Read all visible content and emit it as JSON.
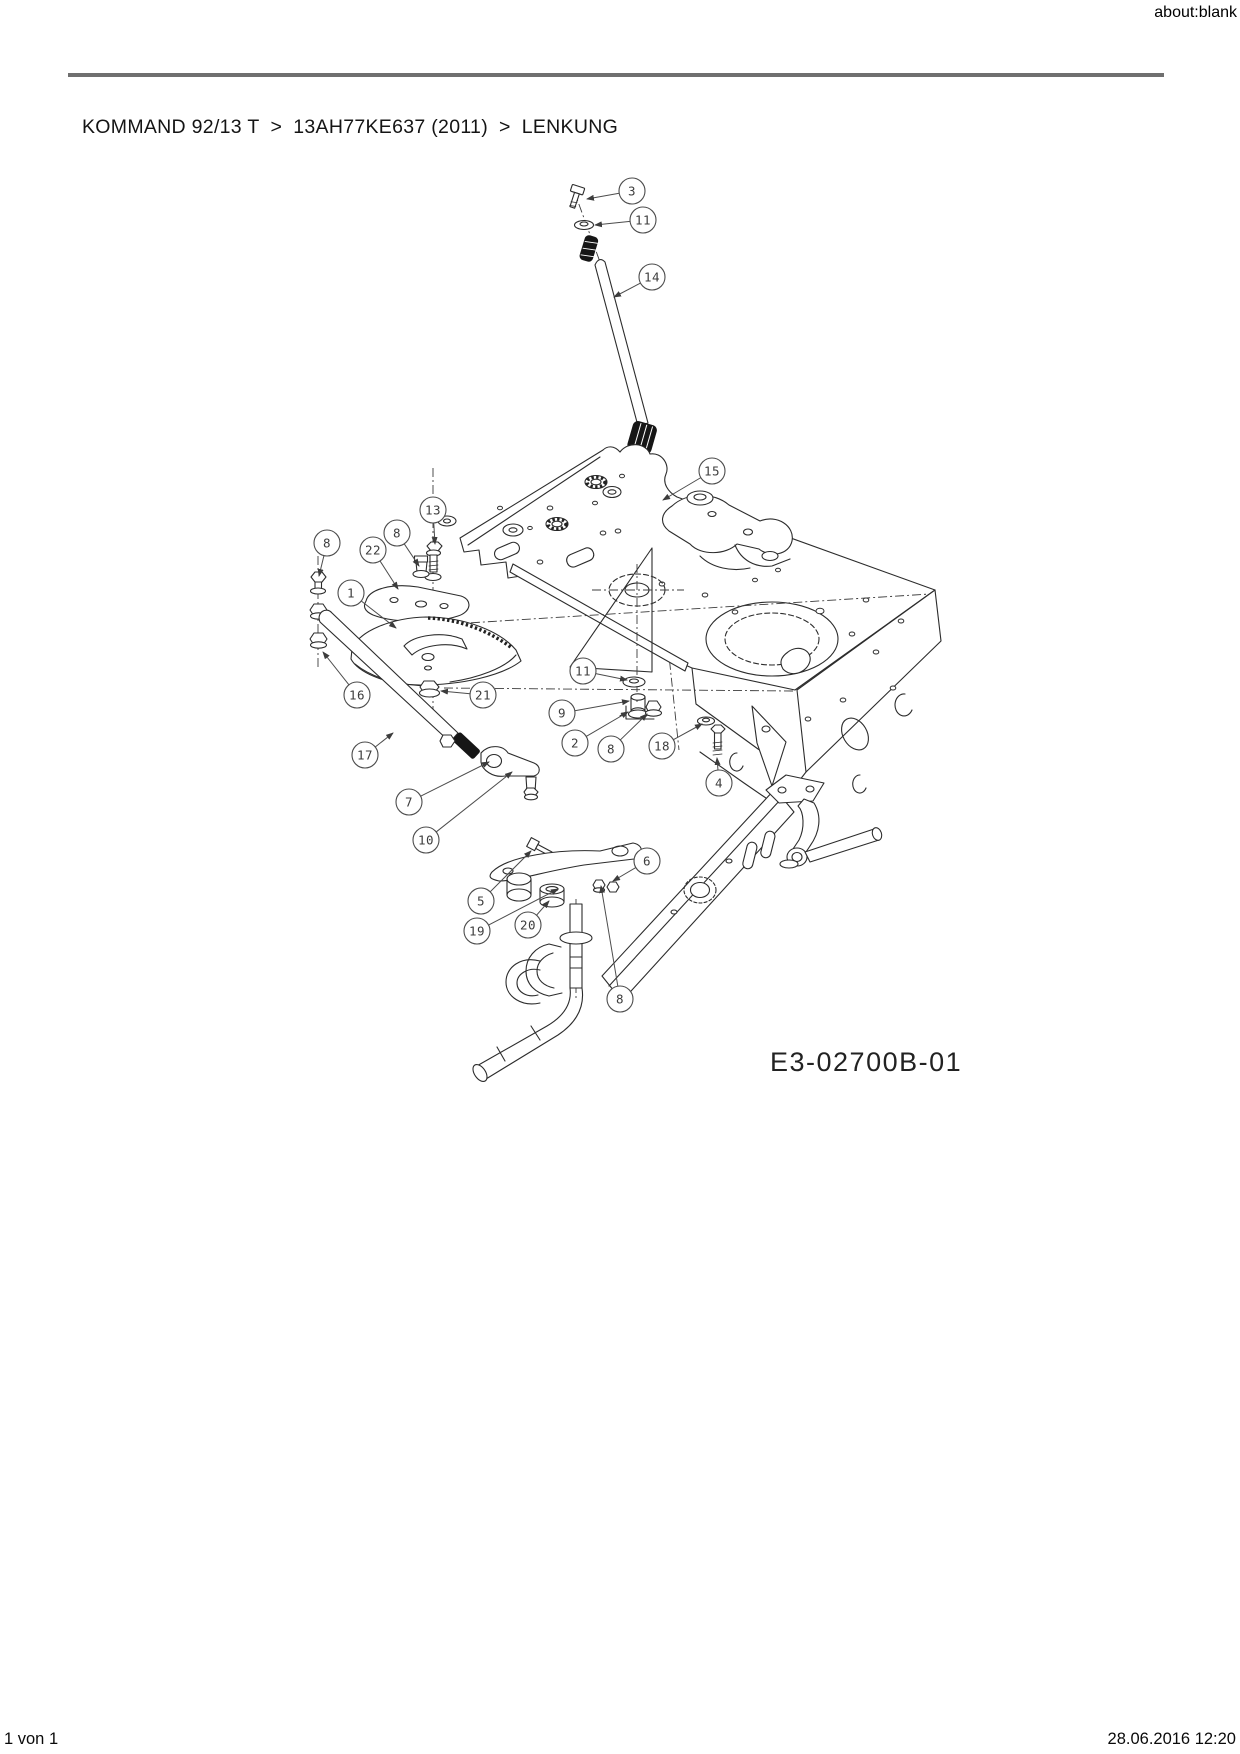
{
  "page": {
    "header": {
      "url_label": "about:blank"
    },
    "breadcrumb": {
      "items": [
        "KOMMAND 92/13 T",
        "13AH77KE637 (2011)",
        "LENKUNG"
      ],
      "separator": ">"
    },
    "footer": {
      "page_count": "1 von 1",
      "timestamp": "28.06.2016 12:20"
    }
  },
  "diagram": {
    "drawing_number": "E3-02700B-01",
    "colors": {
      "line": "#2c2c2c",
      "rule": "#6f6f6f",
      "callout": "#4c4c4c"
    },
    "callouts": [
      {
        "label": "3",
        "cx": 632,
        "cy": 191,
        "tx": 587,
        "ty": 199
      },
      {
        "label": "11",
        "cx": 643,
        "cy": 220,
        "tx": 595,
        "ty": 225
      },
      {
        "label": "14",
        "cx": 652,
        "cy": 277,
        "tx": 614,
        "ty": 297
      },
      {
        "label": "15",
        "cx": 712,
        "cy": 471,
        "tx": 663,
        "ty": 500
      },
      {
        "label": "13",
        "cx": 433,
        "cy": 510,
        "tx": 435,
        "ty": 544
      },
      {
        "label": "8",
        "cx": 327,
        "cy": 543,
        "tx": 319,
        "ty": 576
      },
      {
        "label": "22",
        "cx": 373,
        "cy": 550,
        "tx": 398,
        "ty": 589
      },
      {
        "label": "8",
        "cx": 397,
        "cy": 533,
        "tx": 419,
        "ty": 566
      },
      {
        "label": "1",
        "cx": 351,
        "cy": 593,
        "tx": 396,
        "ty": 628
      },
      {
        "label": "16",
        "cx": 357,
        "cy": 695,
        "tx": 323,
        "ty": 652
      },
      {
        "label": "21",
        "cx": 483,
        "cy": 695,
        "tx": 441,
        "ty": 691
      },
      {
        "label": "17",
        "cx": 365,
        "cy": 755,
        "tx": 393,
        "ty": 733
      },
      {
        "label": "7",
        "cx": 409,
        "cy": 802,
        "tx": 489,
        "ty": 762
      },
      {
        "label": "10",
        "cx": 426,
        "cy": 840,
        "tx": 512,
        "ty": 772
      },
      {
        "label": "11",
        "cx": 583,
        "cy": 671,
        "tx": 627,
        "ty": 680
      },
      {
        "label": "9",
        "cx": 562,
        "cy": 713,
        "tx": 629,
        "ty": 701
      },
      {
        "label": "2",
        "cx": 575,
        "cy": 743,
        "tx": 628,
        "ty": 712
      },
      {
        "label": "8",
        "cx": 611,
        "cy": 749,
        "tx": 647,
        "ty": 714
      },
      {
        "label": "18",
        "cx": 662,
        "cy": 746,
        "tx": 702,
        "ty": 724
      },
      {
        "label": "4",
        "cx": 719,
        "cy": 783,
        "tx": 717,
        "ty": 758
      },
      {
        "label": "5",
        "cx": 481,
        "cy": 901,
        "tx": 531,
        "ty": 851
      },
      {
        "label": "19",
        "cx": 477,
        "cy": 931,
        "tx": 558,
        "ty": 889
      },
      {
        "label": "20",
        "cx": 528,
        "cy": 925,
        "tx": 549,
        "ty": 901
      },
      {
        "label": "6",
        "cx": 647,
        "cy": 861,
        "tx": 613,
        "ty": 881
      },
      {
        "label": "8",
        "cx": 620,
        "cy": 999,
        "tx": 601,
        "ty": 886
      }
    ]
  }
}
